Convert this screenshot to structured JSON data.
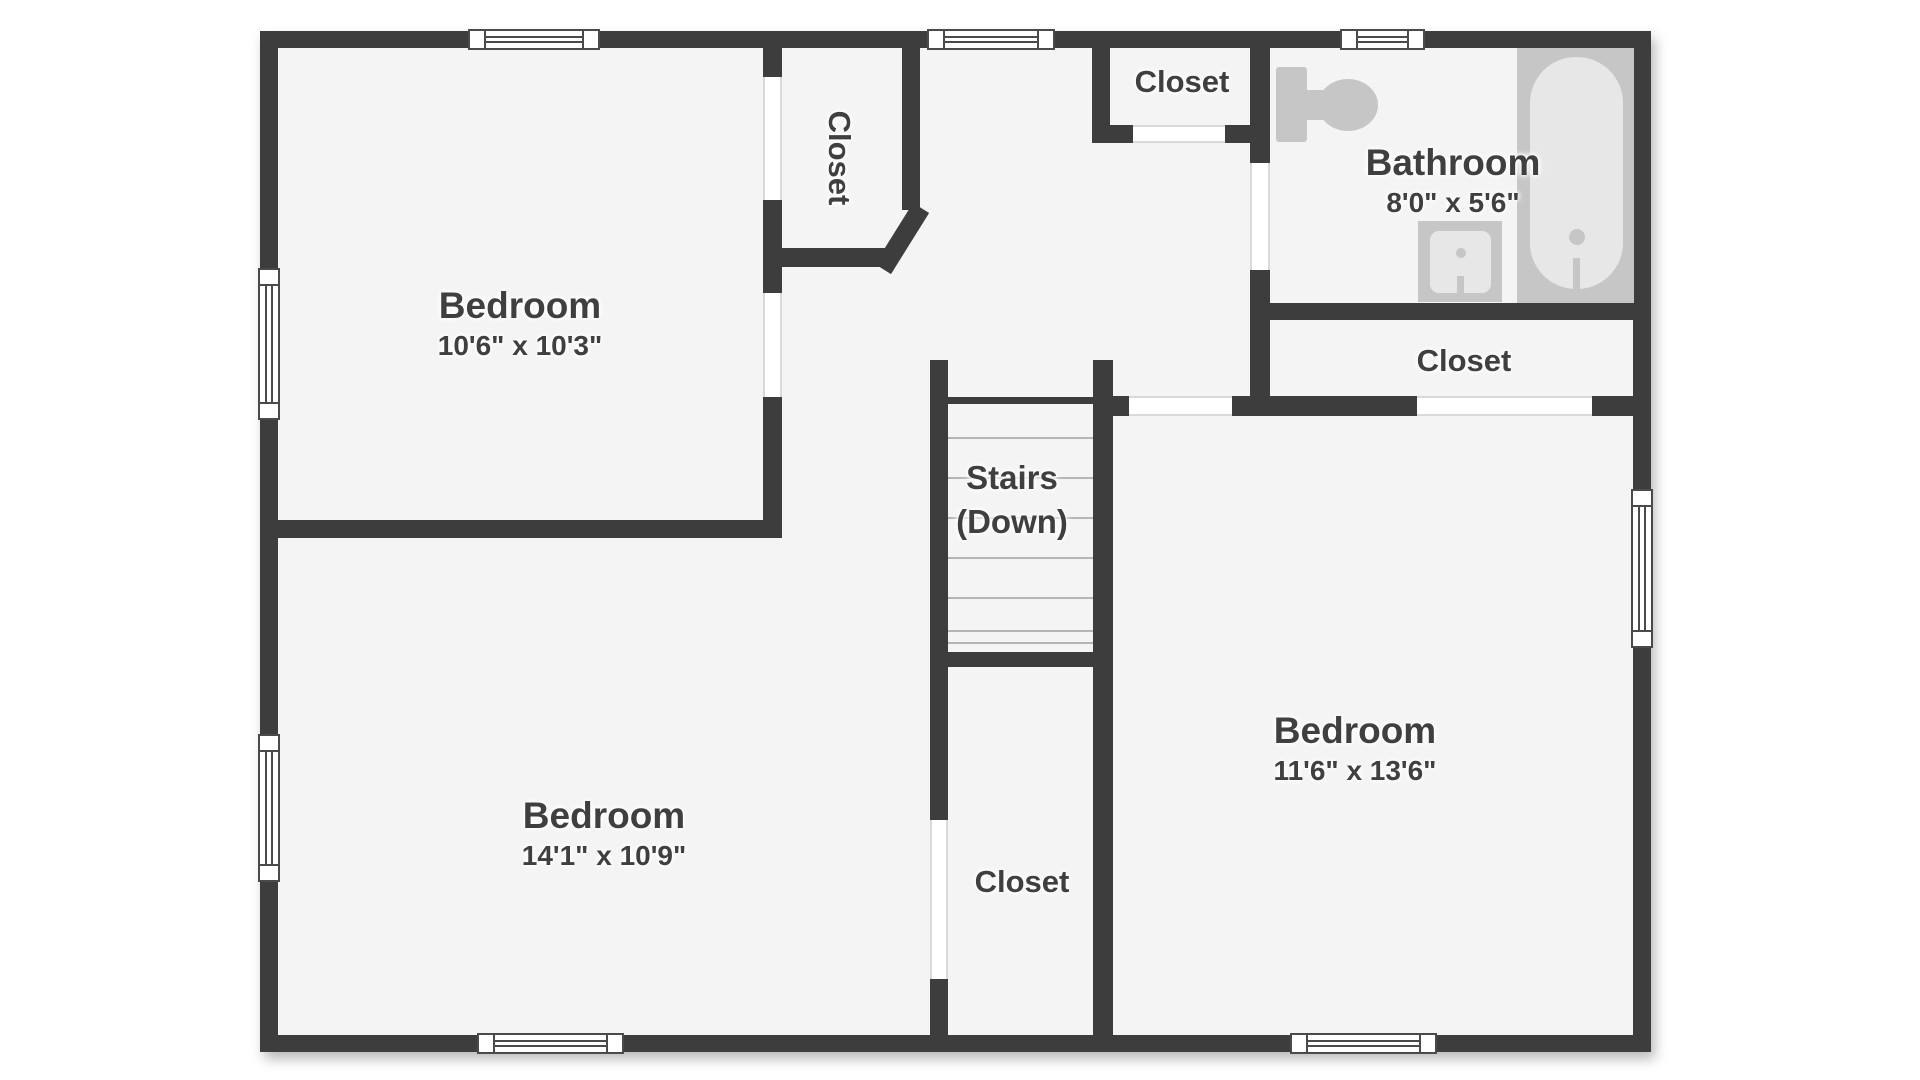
{
  "plan_title": "Second Floor Plan",
  "colors": {
    "wall": "#3d3d3d",
    "floor": "#f4f4f4",
    "fixture": "#c6c6c6",
    "fixture_light": "#e7e7e7",
    "label_text": "#3f3f3f"
  },
  "labels": {
    "bedroom_top_left": {
      "name": "Bedroom",
      "dims": "10'6\" x 10'3\""
    },
    "bedroom_bottom_left": {
      "name": "Bedroom",
      "dims": "14'1\" x 10'9\""
    },
    "bedroom_right": {
      "name": "Bedroom",
      "dims": "11'6\" x 13'6\""
    },
    "bathroom": {
      "name": "Bathroom",
      "dims": "8'0\" x 5'6\""
    },
    "closet_vertical": {
      "name": "Closet"
    },
    "closet_top": {
      "name": "Closet"
    },
    "closet_right": {
      "name": "Closet"
    },
    "closet_bottom": {
      "name": "Closet"
    },
    "stairs": {
      "name": "Stairs",
      "direction": "(Down)"
    }
  },
  "icons": [
    "toilet-icon",
    "sink-icon",
    "bathtub-icon",
    "window",
    "door-opening",
    "stairs-treads"
  ]
}
